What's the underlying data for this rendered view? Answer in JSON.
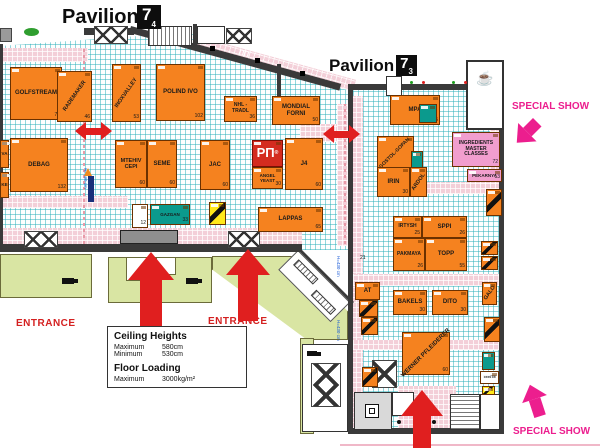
{
  "colors": {
    "booth_orange": "#F5821F",
    "teal_booth": "#0B9A8D",
    "special_pink_booth": "#F19ECE",
    "magenta_accent": "#EC1E8E",
    "arrow_red": "#E01F1F",
    "grid_cyan": "#28AFB9",
    "aisle_pink": "#F3CFD8",
    "wall_dark": "#3A3A3A",
    "exterior_green": "#D9E5A3",
    "rp_logo_red": "#D42C1F"
  },
  "pavilions": {
    "left": {
      "word": "Pavilion",
      "hall": "7",
      "sub": "4"
    },
    "right": {
      "word": "Pavilion",
      "hall": "7",
      "sub": "3"
    }
  },
  "annotations": {
    "entrance_left": "ENTRANCE",
    "entrance_center": "ENTRANCE",
    "special_show_top": "SPECIAL SHOW",
    "special_show_bottom": "SPECIAL SHOW",
    "wall_passage": "ПП",
    "aisle_number": "21",
    "height_note": "H=430 cm"
  },
  "legend": {
    "ceiling_title": "Ceiling Heights",
    "ceiling_max_label": "Maximum",
    "ceiling_max_value": "580cm",
    "ceiling_min_label": "Minimum",
    "ceiling_min_value": "530cm",
    "floor_title": "Floor Loading",
    "floor_max_label": "Maximum",
    "floor_max_value": "3000kg/m²"
  },
  "icons": {
    "coffee": "☕"
  },
  "booths": {
    "golfstream": {
      "name": "GOLFSTREAM",
      "num": "70"
    },
    "rademaker": {
      "name": "RADEMAKER",
      "num": "46"
    },
    "inoxvalley": {
      "name": "INOXVALLEY",
      "num": "53"
    },
    "polindivo": {
      "name": "POLIND IVO",
      "num": "102"
    },
    "nhl_tradl": {
      "name": "NHL - TRADL",
      "num": "36"
    },
    "mondial_forni": {
      "name": "MONDIAL FORNI",
      "num": "50"
    },
    "va": {
      "name": "VA"
    },
    "ke": {
      "name": "KE"
    },
    "debag": {
      "name": "DEBAG",
      "num": "132"
    },
    "mtehiv_cepi": {
      "name": "MTEHIV CEPI",
      "num": "60"
    },
    "seme": {
      "name": "SEME",
      "num": "60"
    },
    "jac": {
      "name": "JAC",
      "num": "60"
    },
    "rp": {
      "name": "РП",
      "reg": "®"
    },
    "angel_yeast": {
      "name": "ANGEL YEAST",
      "num": "30"
    },
    "j4": {
      "name": "J4",
      "num": "60"
    },
    "booth_12": {
      "num": "12"
    },
    "gazgan": {
      "name": "GAZGAN",
      "num": "33"
    },
    "lappas": {
      "name": "LAPPAS",
      "num": "65"
    },
    "mpa": {
      "name": "MPA",
      "num": "45"
    },
    "gostol_gopan": {
      "name": "GOSTOL-GOPAN"
    },
    "irin": {
      "name": "IRIN",
      "num": "30"
    },
    "ardol": {
      "name": "ARDOL"
    },
    "ingredients": {
      "name": "INGREDIENTS MASTER CLASSES",
      "num": "72"
    },
    "pekarnya": {
      "name": "PEKARNYA",
      "num": "13"
    },
    "irtysh": {
      "name": "IRTYSH",
      "num": "25"
    },
    "sppi": {
      "name": "SPPI",
      "num": "26"
    },
    "pakmaya": {
      "name": "PAKMAYA",
      "num": "26"
    },
    "topp": {
      "name": "TOPP",
      "num": "55"
    },
    "at": {
      "name": "AT"
    },
    "bakels": {
      "name": "BAKELS",
      "num": "30"
    },
    "dito": {
      "name": "DITO",
      "num": "30"
    },
    "galo": {
      "name": "GALO"
    },
    "werner": {
      "name": "WERNER PFLEIDERER",
      "num": "60"
    },
    "tente": {
      "name": "TENTE"
    }
  }
}
